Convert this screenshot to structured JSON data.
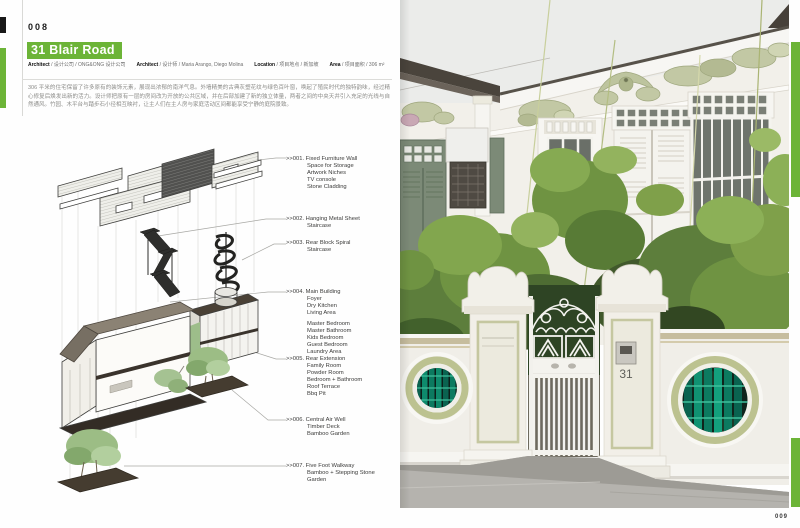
{
  "page": {
    "left_number": "008",
    "right_number": "009"
  },
  "title": {
    "text": "31 Blair Road"
  },
  "meta": [
    {
      "label": "Architect",
      "value": "设计公司 / ONG&ONG 设计公司"
    },
    {
      "label": "Architect",
      "value": "设计师 / Maria Arango, Diego Molina"
    },
    {
      "label": "Location",
      "value": "项目地点 / 新加坡"
    },
    {
      "label": "Area",
      "value": "项目面积 / 306 m²"
    }
  ],
  "intro": "306 平米的住宅保留了许多原有的装饰元素，展现出浓郁的南洋气息。外墙精美的古典灰塑花纹与绿色百叶窗，唤起了殖民时代的独特韵味，经过精心修复后焕发出新的活力。设计师把原有一层的房间改为开放的公共区域，并在后部加建了新的独立体量，两者之间的中央天井引入充足的光线与自然通风。竹园、木平台与踏步石小径相互映衬，让主人们在主人房与家庭活动区间都能享受宁静的庭院景致。",
  "callouts": [
    {
      "num": ">>001.",
      "lines": [
        "Fixed Furniture Wall",
        "Space for Storage",
        "Artwork Niches",
        "TV console",
        "Stone Cladding"
      ]
    },
    {
      "num": ">>002.",
      "lines": [
        "Hanging Metal Sheet",
        "Staircase"
      ]
    },
    {
      "num": ">>003.",
      "lines": [
        "Rear Block Spiral",
        "Staircase"
      ]
    },
    {
      "num": ">>004.",
      "lines": [
        "Main Building",
        "Foyer",
        "Dry Kitchen",
        "Living Area",
        "",
        "Master Bedroom",
        "Master Bathroom",
        "Kids Bedroom",
        "Guest Bedroom",
        "Laundry Area"
      ]
    },
    {
      "num": ">>005.",
      "lines": [
        "Rear Extension",
        "Family Room",
        "Powder Room",
        "Bedroom + Bathroom",
        "Roof Terrace",
        "Bbq Pit"
      ]
    },
    {
      "num": ">>006.",
      "lines": [
        "Central Air Well",
        "Timber Deck",
        "Bamboo Garden"
      ]
    },
    {
      "num": ">>007.",
      "lines": [
        "Five Foot Walkway",
        "Bamboo + Stepping Stone",
        "Garden"
      ]
    }
  ],
  "photo": {
    "house_number": "31"
  },
  "colors": {
    "accent_green": "#6cb437",
    "plaster_green": "#c2c8a4",
    "shutter_green": "#7c8a77",
    "glass_bamboo_teal": "#0c7a60",
    "roof_dark": "#4a443c"
  }
}
